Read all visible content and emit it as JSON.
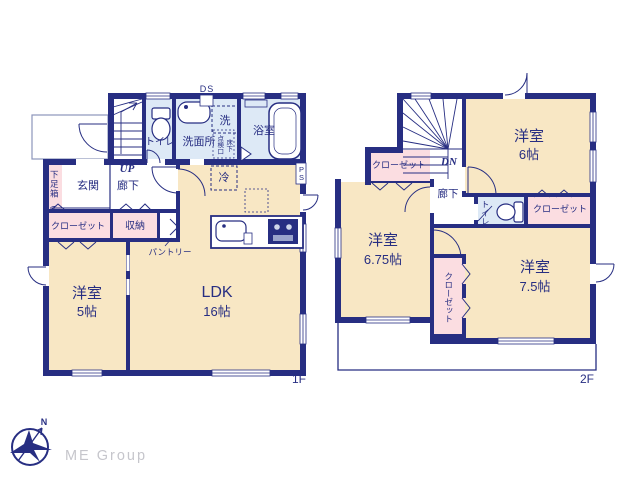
{
  "palette": {
    "wall_navy": "#272e82",
    "room_cream": "#f8e7c4",
    "wet_area_blue": "#dde9f6",
    "closet_pink": "#fbdde1",
    "logo_gray": "#c6c6cc"
  },
  "floor1": {
    "label": "1F",
    "duct": "DS",
    "stairs": "UP",
    "toilet": "トイレ",
    "washroom": "洗面所",
    "washer": "洗",
    "hatch_col1": "床下",
    "hatch_col2": "点検口",
    "bathroom": "浴室",
    "shoe_box": "下足箱",
    "shoe_box_t": "T",
    "entrance": "玄関",
    "hallway": "廊下",
    "closet": "クローゼット",
    "storage": "収納",
    "pantry": "パントリー",
    "fridge": "冷",
    "ps_line1": "P",
    "ps_line2": "S",
    "room5": {
      "name": "洋室",
      "size": "5帖"
    },
    "ldk": {
      "name": "LDK",
      "size": "16帖"
    }
  },
  "floor2": {
    "label": "2F",
    "stairs": "DN",
    "hallway": "廊下",
    "toilet": "トイレ",
    "closet_nw": "クローゼット",
    "closet_east": "クローゼット",
    "closet_mid": "クローゼット",
    "room6": {
      "name": "洋室",
      "size": "6帖"
    },
    "room675": {
      "name": "洋室",
      "size": "6.75帖"
    },
    "room75": {
      "name": "洋室",
      "size": "7.5帖"
    }
  },
  "logo": {
    "company": "ME Group",
    "north": "N"
  }
}
